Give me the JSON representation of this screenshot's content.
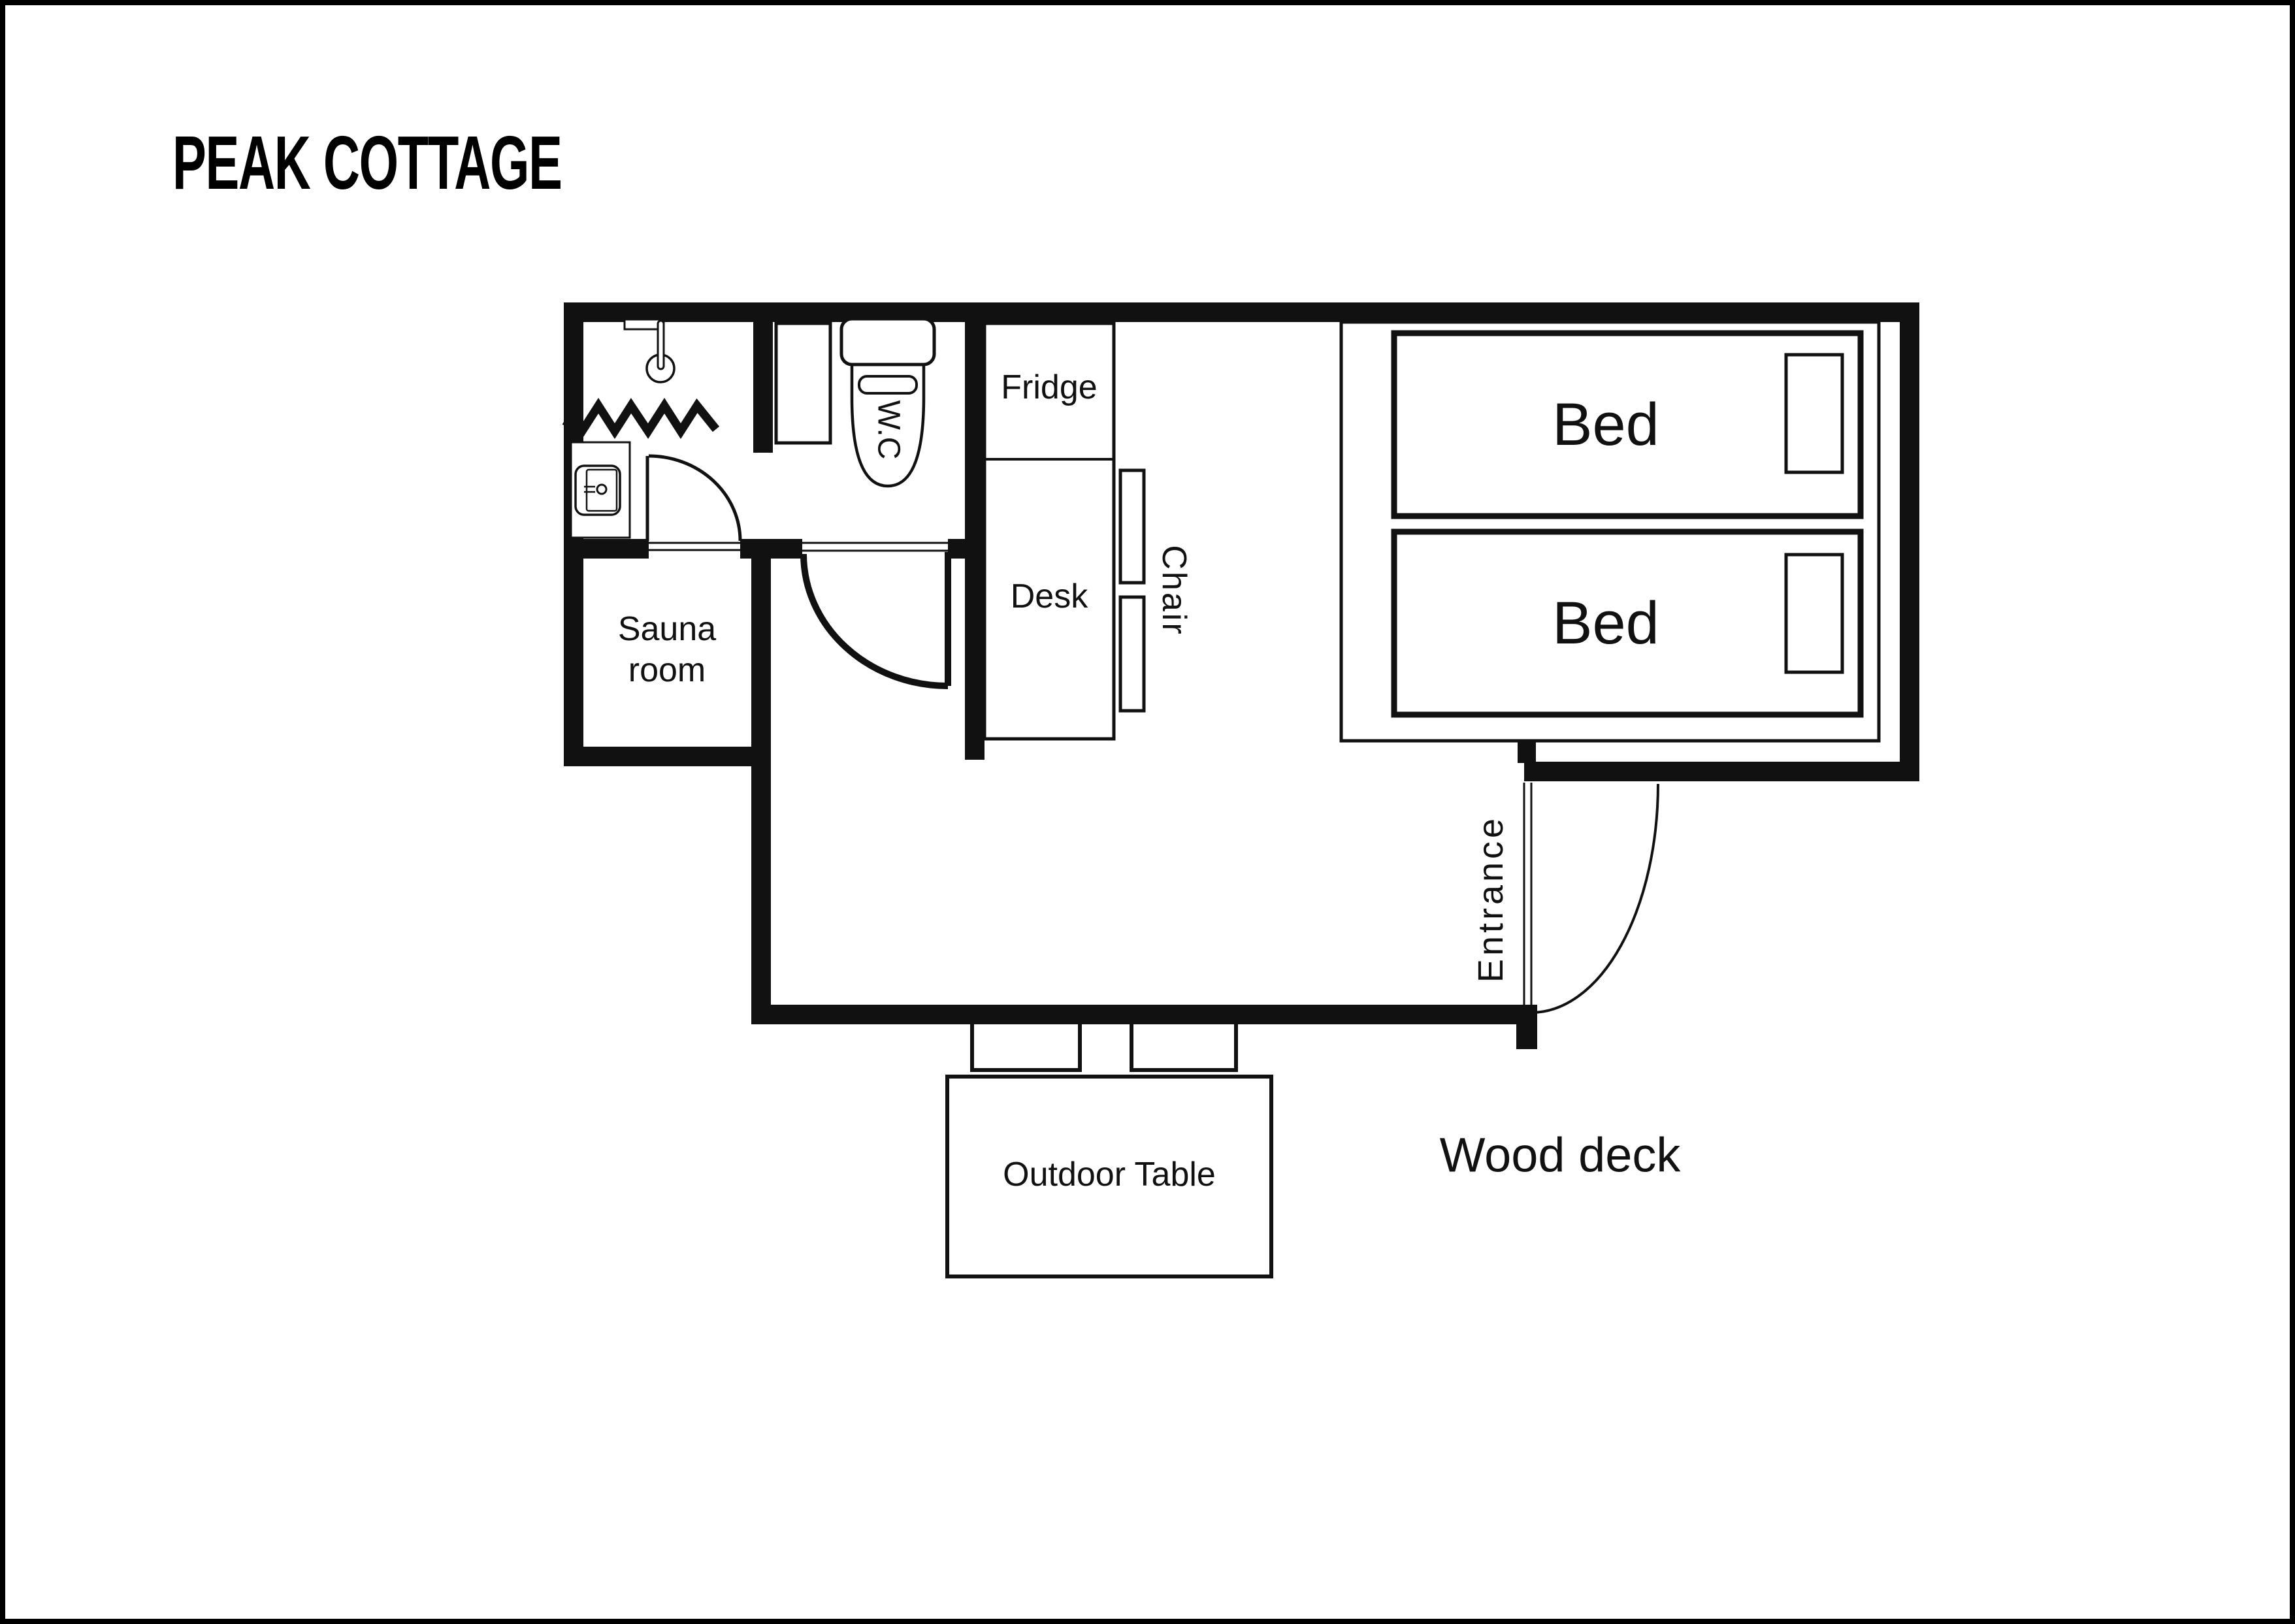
{
  "page": {
    "background": "#ffffff",
    "ink": "#000000"
  },
  "title": {
    "text": "PEAK COTTAGE"
  },
  "plan": {
    "rooms": {
      "sauna": {
        "line1": "Sauna",
        "line2": "room"
      },
      "wc": {
        "label": "W.C"
      },
      "entrance": {
        "label": "Entrance"
      },
      "wood_deck": {
        "label": "Wood deck"
      }
    },
    "furniture": {
      "fridge": "Fridge",
      "desk": "Desk",
      "chair": "Chair",
      "bed_top": "Bed",
      "bed_bottom": "Bed",
      "outdoor_table": "Outdoor Table"
    }
  }
}
